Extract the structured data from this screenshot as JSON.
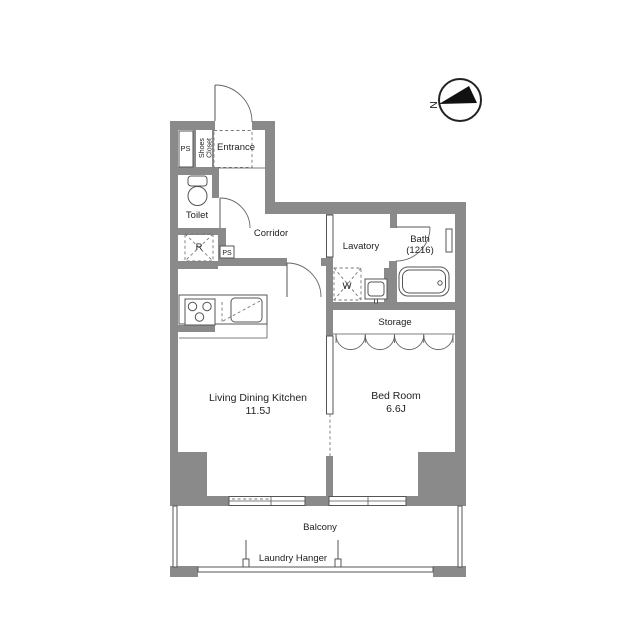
{
  "title": "Apartment Floor Plan",
  "colors": {
    "wall": "#8a8a8a",
    "line": "#555555",
    "text": "#222222"
  },
  "compass": {
    "north_label": "N"
  },
  "rooms": {
    "ps_top": "PS",
    "shoes_closet_line1": "Shoes",
    "shoes_closet_line2": "Closet",
    "entrance": "Entrance",
    "toilet": "Toilet",
    "refrigerator_space": "R",
    "ps_small": "PS",
    "corridor": "Corridor",
    "lavatory": "Lavatory",
    "washer_space": "W",
    "bath_line1": "Bath",
    "bath_line2": "(1216)",
    "storage": "Storage",
    "ldk_name": "Living Dining Kitchen",
    "ldk_size": "11.5J",
    "bedroom_name": "Bed Room",
    "bedroom_size": "6.6J",
    "balcony": "Balcony",
    "laundry_hanger": "Laundry Hanger"
  }
}
